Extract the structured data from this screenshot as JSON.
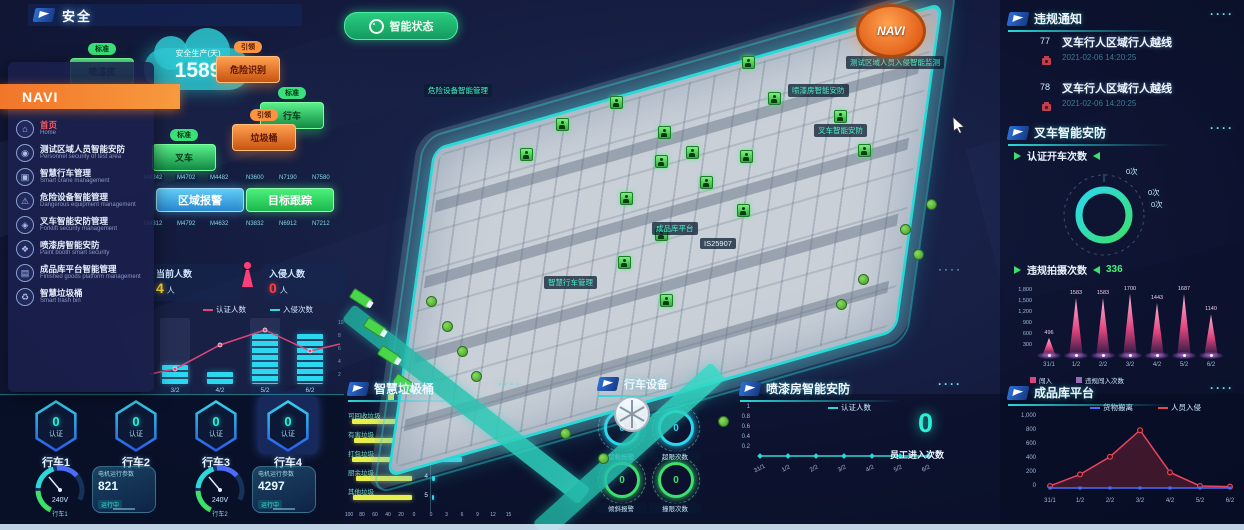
{
  "ui": {
    "dots": "····"
  },
  "header": {
    "title": "安全"
  },
  "status_button": {
    "label": "智能状态"
  },
  "cloud": {
    "label": "安全生产(天)",
    "value": "1589"
  },
  "nav": {
    "title": "NAVI",
    "items": [
      {
        "label": "首页",
        "sub": "Home",
        "active": true
      },
      {
        "label": "测试区域人员智能安防",
        "sub": "Personnel security of test area",
        "active": false
      },
      {
        "label": "智慧行车管理",
        "sub": "Smart crane management",
        "active": false
      },
      {
        "label": "危险设备智能管理",
        "sub": "Dangerous equipment management",
        "active": false
      },
      {
        "label": "叉车智能安防管理",
        "sub": "Forklift security management",
        "active": false
      },
      {
        "label": "喷漆房智能安防",
        "sub": "Paint booth smart security",
        "active": false
      },
      {
        "label": "成品库平台智能管理",
        "sub": "Finished goods platform management",
        "active": false
      },
      {
        "label": "智慧垃圾桶",
        "sub": "Smart trash bin",
        "active": false
      }
    ]
  },
  "boxes": [
    {
      "tag": "标准",
      "label": "喷漆房",
      "color": "green"
    },
    {
      "tag": "引领",
      "label": "危险识别",
      "color": "orange"
    },
    {
      "tag": "标准",
      "label": "行车",
      "color": "green"
    },
    {
      "tag": "引领",
      "label": "垃圾桶",
      "color": "orange"
    },
    {
      "tag": "标准",
      "label": "叉车",
      "color": "green"
    }
  ],
  "zone": {
    "blue_button": "区域报警",
    "green_button": "目标跟踪",
    "codes_top": [
      "M4242",
      "M4702",
      "M4482",
      "N3600",
      "N7190",
      "N7580"
    ],
    "codes_bottom": [
      "M4312",
      "M4792",
      "M4632",
      "N3832",
      "N6912",
      "N7212"
    ]
  },
  "people": {
    "current_label": "当前人数",
    "current_value": "4",
    "current_unit": "人",
    "intrusion_label": "入侵人数",
    "intrusion_value": "0",
    "intrusion_unit": "人"
  },
  "violations": {
    "title": "违规通知",
    "items": [
      {
        "id": "77",
        "text": "叉车行人区域行人越线",
        "time": "2021-02-06 14:20:25"
      },
      {
        "id": "78",
        "text": "叉车行人区域行人越线",
        "time": "2021-02-06 14:20:25"
      }
    ]
  },
  "forklift": {
    "title": "叉车智能安防",
    "auth_label": "认证开车次数",
    "donut_labels": [
      "0次",
      "0次",
      "0次"
    ],
    "capture_label": "违规拍摄次数",
    "capture_value": "336"
  },
  "finished": {
    "title": "成品库平台"
  },
  "paint": {
    "title": "喷漆房智能安防",
    "big_value": "0",
    "big_label": "员工进入次数"
  },
  "trash": {
    "title": "智慧垃圾桶",
    "legend_left": "容量",
    "legend_right": "数量"
  },
  "crane_equipment": {
    "title": "行车设备",
    "rings": [
      {
        "value": "0",
        "label": "超载报警",
        "color": "#2bd8f0"
      },
      {
        "value": "0",
        "label": "超限次数",
        "color": "#2bd8f0"
      },
      {
        "value": "0",
        "label": "倾斜报警",
        "color": "#3ce06a"
      },
      {
        "value": "0",
        "label": "撞限次数",
        "color": "#3ce06a"
      }
    ]
  },
  "cranes": {
    "badges": [
      {
        "name": "行车1",
        "value": "0",
        "label": "认证"
      },
      {
        "name": "行车2",
        "value": "0",
        "label": "认证"
      },
      {
        "name": "行车3",
        "value": "0",
        "label": "认证"
      },
      {
        "name": "行车4",
        "value": "0",
        "label": "认证"
      }
    ],
    "gauges": [
      {
        "name": "行车1",
        "reading": "240V",
        "card_title": "电机运行参数",
        "card_value": "821",
        "card_sub": "运行中"
      },
      {
        "name": "行车2",
        "reading": "240V",
        "card_title": "电机运行参数",
        "card_value": "4297",
        "card_sub": "运行中"
      }
    ]
  },
  "map": {
    "navi_badge": "NAVI",
    "labels": [
      {
        "text": "危险设备智能管理",
        "x": 424,
        "y": 84,
        "white": false
      },
      {
        "text": "测试区域人员入侵智能监测",
        "x": 846,
        "y": 56,
        "white": false
      },
      {
        "text": "喷漆房智能安防",
        "x": 788,
        "y": 84,
        "white": false
      },
      {
        "text": "叉车智能安防",
        "x": 814,
        "y": 124,
        "white": false
      },
      {
        "text": "成品库平台",
        "x": 652,
        "y": 222,
        "white": false
      },
      {
        "text": "智慧行车管理",
        "x": 544,
        "y": 276,
        "white": false
      },
      {
        "text": "IS25907",
        "x": 700,
        "y": 238,
        "white": true
      }
    ],
    "markers": [
      [
        520,
        148
      ],
      [
        556,
        118
      ],
      [
        610,
        96
      ],
      [
        658,
        126
      ],
      [
        686,
        146
      ],
      [
        740,
        150
      ],
      [
        700,
        176
      ],
      [
        655,
        155
      ],
      [
        620,
        192
      ],
      [
        737,
        204
      ],
      [
        655,
        228
      ],
      [
        618,
        256
      ],
      [
        660,
        294
      ],
      [
        834,
        110
      ],
      [
        858,
        144
      ],
      [
        768,
        92
      ],
      [
        742,
        56
      ]
    ],
    "trees": [
      [
        426,
        296
      ],
      [
        442,
        321
      ],
      [
        457,
        346
      ],
      [
        471,
        371
      ],
      [
        900,
        224
      ],
      [
        913,
        249
      ],
      [
        926,
        199
      ],
      [
        598,
        453
      ],
      [
        560,
        428
      ],
      [
        836,
        299
      ],
      [
        858,
        274
      ],
      [
        718,
        416
      ]
    ],
    "trucks": [
      [
        350,
        293
      ],
      [
        364,
        322
      ],
      [
        378,
        350
      ],
      [
        393,
        378
      ]
    ]
  },
  "chart_data": [
    {
      "id": "left_combo",
      "type": "bar+line",
      "categories": [
        "3/2",
        "4/2",
        "5/2",
        "6/2"
      ],
      "series": [
        {
          "name": "认证人数",
          "type": "line",
          "color": "#e0447e",
          "values": [
            2.5,
            6.5,
            9,
            5.5
          ]
        },
        {
          "name": "入侵次数",
          "type": "bar",
          "color": "#2bd8f0",
          "values": [
            3,
            2,
            8,
            8
          ]
        }
      ],
      "ylim": [
        0,
        10
      ],
      "right_axis_ticks": [
        "10",
        "8",
        "6",
        "4",
        "2"
      ]
    },
    {
      "id": "violation_capture",
      "type": "bar",
      "title": "违规拍摄次数",
      "categories": [
        "31/1",
        "1/2",
        "2/2",
        "3/2",
        "4/2",
        "5/2",
        "6/2"
      ],
      "values": [
        496,
        1583,
        1583,
        1700,
        1443,
        1687,
        1140
      ],
      "yticks": [
        "1,800",
        "1,500",
        "1,200",
        "900",
        "600",
        "300"
      ],
      "ylim": [
        0,
        1800
      ],
      "legend": [
        {
          "label": "闯入",
          "color": "#e0447e"
        },
        {
          "label": "违规闯入次数",
          "color": "#9a6ab8"
        }
      ]
    },
    {
      "id": "finished_goods",
      "type": "line",
      "categories": [
        "31/1",
        "1/2",
        "2/2",
        "3/2",
        "4/2",
        "5/2",
        "6/2"
      ],
      "series": [
        {
          "name": "货物搬离",
          "color": "#4a6cf7",
          "values": [
            0,
            0,
            0,
            0,
            0,
            0,
            0
          ]
        },
        {
          "name": "人员入侵",
          "color": "#e8445a",
          "values": [
            30,
            200,
            460,
            850,
            230,
            30,
            20
          ]
        }
      ],
      "yticks": [
        "1,000",
        "800",
        "600",
        "400",
        "200",
        "0"
      ],
      "ylim": [
        0,
        1000
      ]
    },
    {
      "id": "trash_capacity",
      "type": "bar-h",
      "reversed": true,
      "color": "#e8ef4a",
      "labels": [
        "可回收垃圾",
        "有害垃圾",
        "打包垃圾",
        "厨余垃圾",
        "其他垃圾"
      ],
      "values": [
        96,
        93,
        97,
        91,
        95
      ],
      "axis_ticks": [
        "100",
        "80",
        "60",
        "40",
        "20",
        "0"
      ],
      "xlim": [
        0,
        100
      ]
    },
    {
      "id": "trash_count",
      "type": "bar-h",
      "color": "#2bd8f0",
      "labels": [
        "1",
        "2",
        "3",
        "4",
        "5"
      ],
      "values": [
        15,
        12,
        6,
        0.6,
        0.4
      ],
      "axis_ticks": [
        "0",
        "3",
        "6",
        "9",
        "12",
        "15"
      ],
      "xlim": [
        0,
        15
      ]
    },
    {
      "id": "paint_line",
      "type": "line",
      "categories": [
        "31/1",
        "1/2",
        "2/2",
        "3/2",
        "4/2",
        "5/2",
        "6/2"
      ],
      "series": [
        {
          "name": "认证人数",
          "color": "#2bd8d8",
          "values": [
            0,
            0,
            0,
            0,
            0,
            0,
            0
          ]
        }
      ],
      "yticks": [
        "1",
        "0.8",
        "0.6",
        "0.4",
        "0.2"
      ],
      "ylim": [
        0,
        1
      ]
    }
  ]
}
